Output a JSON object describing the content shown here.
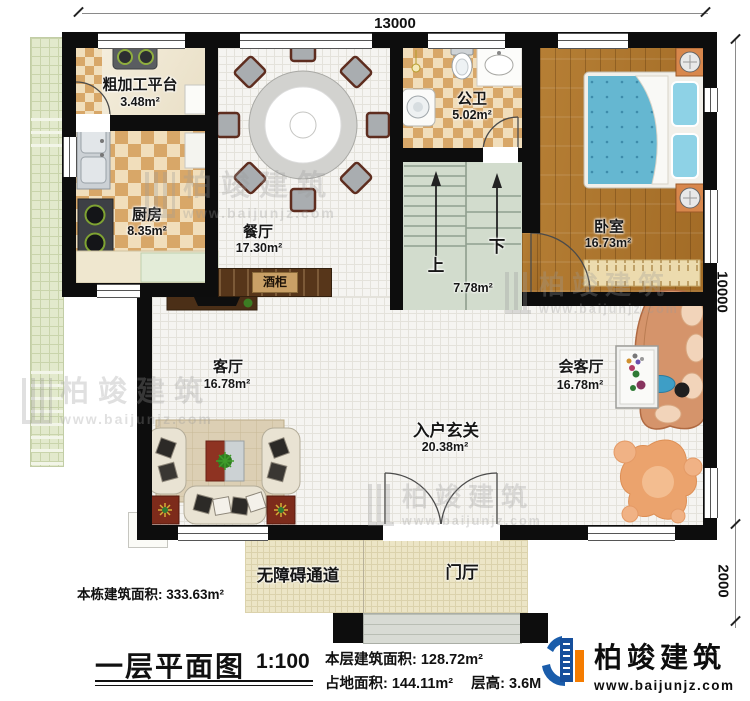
{
  "plan": {
    "dimensions": {
      "top": "13000",
      "right_upper": "10000",
      "right_lower": "2000"
    },
    "rooms": [
      {
        "name": "粗加工平台",
        "area": "3.48m²"
      },
      {
        "name": "厨房",
        "area": "8.35m²"
      },
      {
        "name": "餐厅",
        "area": "17.30m²"
      },
      {
        "name": "公卫",
        "area": "5.02m²"
      },
      {
        "name": "卧室",
        "area": "16.73m²"
      },
      {
        "name": "客厅",
        "area": "16.78m²"
      },
      {
        "name": "会客厅",
        "area": "16.78m²"
      },
      {
        "name": "入户玄关",
        "area": "20.38m²"
      }
    ],
    "stairs": {
      "area": "7.78m²",
      "up": "上",
      "down": "下"
    },
    "wine_cabinet": "酒柜",
    "outdoor": {
      "ramp": "无障碍通道",
      "foyer": "门厅"
    }
  },
  "annotations": {
    "total_area": "本栋建筑面积: 333.63m²",
    "title": "一层平面图",
    "scale": "1:100",
    "floor_area": "本层建筑面积: 128.72m²",
    "land_area": "占地面积: 144.11m²",
    "floor_height": "层高: 3.6M"
  },
  "logo": {
    "name": "柏竣建筑",
    "url": "www.baijunjz.com"
  },
  "watermark": {
    "name": "柏竣建筑",
    "url": "www.baijunjz.com"
  },
  "colors": {
    "wall": "#0d0d0d",
    "logo_blue": "#1a5dab",
    "logo_orange": "#f57c00",
    "bed_blue": "#65b7d1"
  }
}
